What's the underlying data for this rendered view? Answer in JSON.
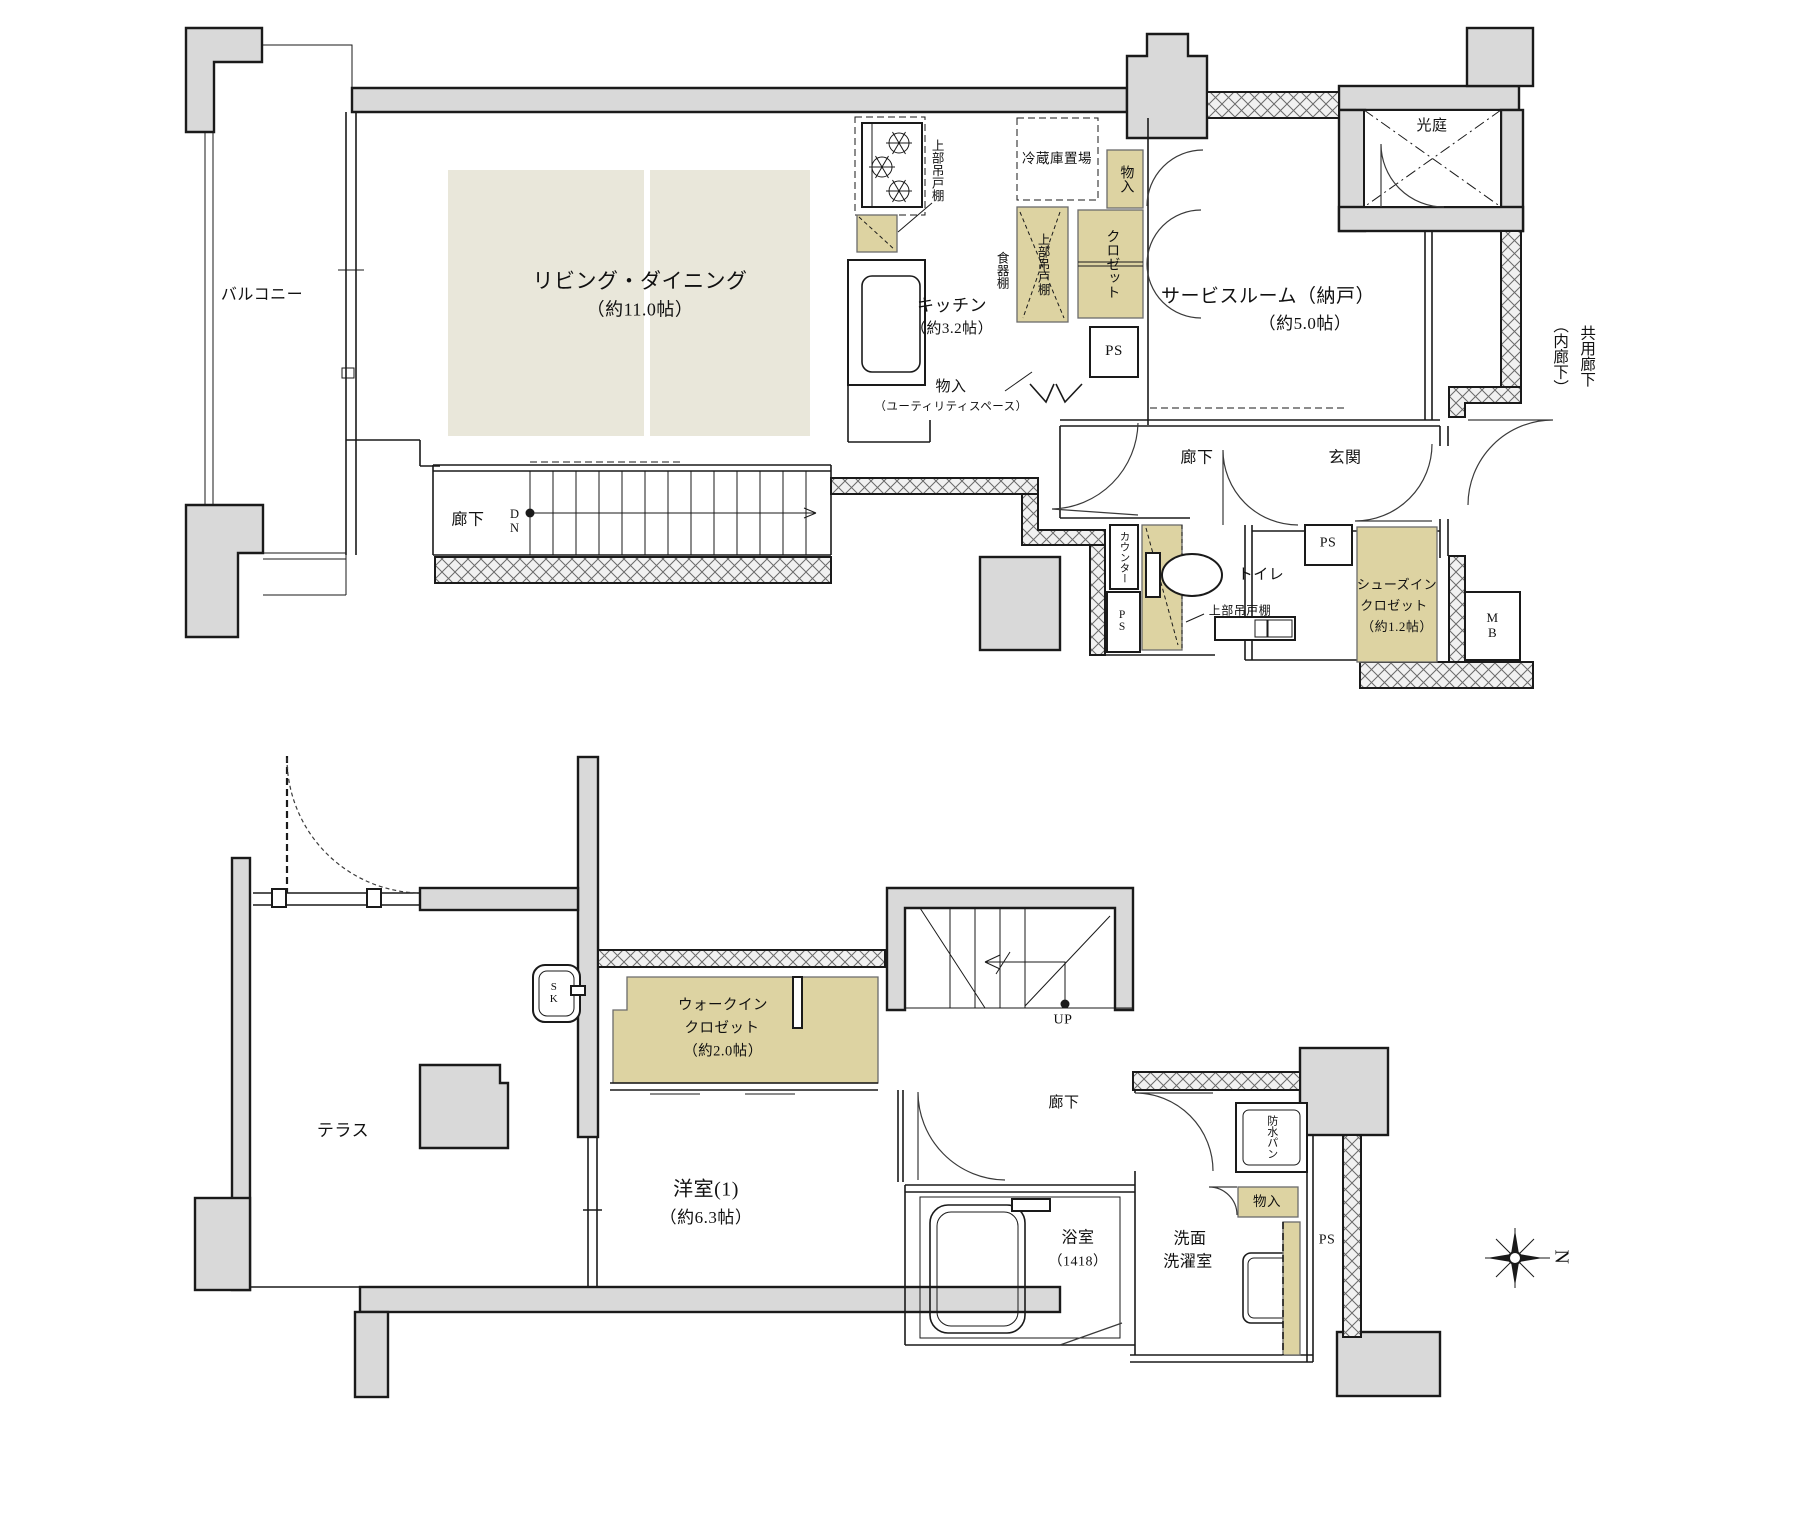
{
  "colors": {
    "wall_gray": "#d9d9d9",
    "floor_beige": "#e9e7da",
    "storage_beige": "#ddd3a2",
    "line": "#1a1a1a"
  },
  "upper": {
    "balcony": "バルコニー",
    "living": {
      "name": "リビング・ダイニング",
      "size": "（約11.0帖）"
    },
    "kitchen": {
      "name": "キッチン",
      "size": "（約3.2帖）"
    },
    "service_room": {
      "name": "サービスルーム（納戸）",
      "size": "（約5.0帖）"
    },
    "light_court": "光庭",
    "shared_corridor": {
      "l1": "共用廊下",
      "l2": "（内廊下）"
    },
    "corridor_left": "廊下",
    "dn": "DN",
    "corridor": "廊下",
    "entrance": "玄関",
    "toilet": "トイレ",
    "counter": "カウンター",
    "hanging_cabinet_stove": "上部吊戸棚",
    "hanging_cabinet_kitchen": "上部吊戸棚",
    "hanging_cabinet_toilet": "上部吊戸棚",
    "fridge_space": "冷蔵庫置場",
    "dish_shelf": "食器棚",
    "storage_top": "物入",
    "closet": "クロゼット",
    "storage_utility": {
      "name": "物入",
      "note": "（ユーティリティスペース）"
    },
    "ps_kitchen": "PS",
    "ps_toilet": "PS",
    "ps_entrance": "PS",
    "mb": "MB",
    "shoes_in_closet": {
      "l1": "シューズイン",
      "l2": "クロゼット",
      "l3": "（約1.2帖）"
    }
  },
  "lower": {
    "terrace": "テラス",
    "sk": "SK",
    "walk_in_closet": {
      "l1": "ウォークイン",
      "l2": "クロゼット",
      "l3": "（約2.0帖）"
    },
    "bedroom": {
      "name": "洋室(1)",
      "size": "（約6.3帖）"
    },
    "up": "UP",
    "corridor": "廊下",
    "bath": {
      "name": "浴室",
      "size": "（1418）"
    },
    "waterproof_pan": "防水パン",
    "storage": "物入",
    "washroom": {
      "l1": "洗面",
      "l2": "洗濯室"
    },
    "ps": "PS"
  },
  "compass": {
    "north": "N"
  }
}
